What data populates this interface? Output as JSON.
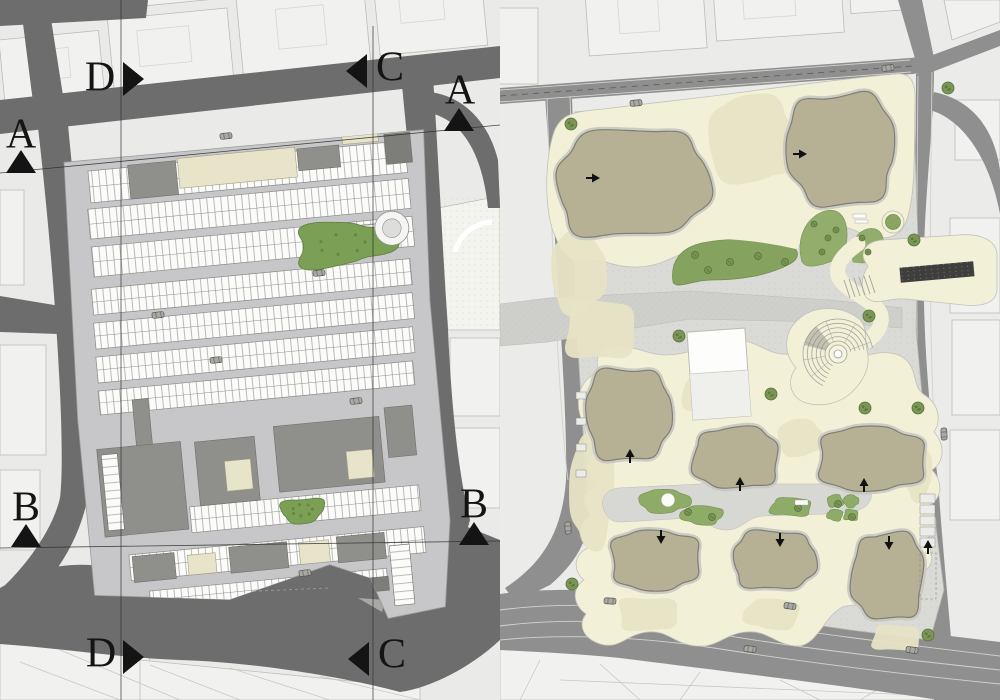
{
  "title": "Architectural site plan pair",
  "colors": {
    "bg": "#eaeae8",
    "city_block": "#f1f1ef",
    "city_line": "#bcbcb7",
    "road_left": "#6d6d6d",
    "road_right": "#8f8f8f",
    "road_edge": "#cfcfca",
    "plaza": "#c7c7c9",
    "stall_bg": "#fbfbf9",
    "stall_line": "#8f8f8b",
    "building_gray": "#8f8f8c",
    "building_dark": "#7d7d79",
    "beige": "#e8e4ca",
    "green": "#7ba055",
    "green_edge": "#5d7f3f",
    "paving": "#dadad6",
    "cream": "#f3f0d8",
    "khaki": "#e7e3c5",
    "olive": "#b6b194",
    "olive_edge": "#7f7f76",
    "olive_ring": "#c8c8c0",
    "lawn": "#85a35f",
    "bed": "#93ad6d",
    "tree": "#7b9554",
    "tree_edge": "#55713a",
    "marker": "#141414",
    "canopy": "#3e3e3c",
    "white_bldg": "#fdfdfc"
  },
  "left_plan": {
    "name": "ground floor plan with section markers",
    "markers": [
      {
        "id": "D-top",
        "label": "D",
        "lx": 100,
        "ly": 81,
        "dir": "right",
        "tip": [
          144,
          79
        ]
      },
      {
        "id": "C-top",
        "label": "C",
        "lx": 390,
        "ly": 71,
        "dir": "left",
        "tip": [
          346,
          71
        ]
      },
      {
        "id": "A-top-right",
        "label": "A",
        "lx": 460,
        "ly": 94,
        "dir": "up",
        "tip": [
          459,
          108
        ]
      },
      {
        "id": "A-left",
        "label": "A",
        "lx": 21,
        "ly": 138,
        "dir": "up",
        "tip": [
          21,
          150
        ]
      },
      {
        "id": "B-left",
        "label": "B",
        "lx": 26,
        "ly": 511,
        "dir": "up",
        "tip": [
          26,
          524
        ]
      },
      {
        "id": "B-right",
        "label": "B",
        "lx": 474,
        "ly": 508,
        "dir": "up",
        "tip": [
          474,
          522
        ]
      },
      {
        "id": "D-bottom",
        "label": "D",
        "lx": 101,
        "ly": 657,
        "dir": "right",
        "tip": [
          144,
          657
        ]
      },
      {
        "id": "C-bottom",
        "label": "C",
        "lx": 392,
        "ly": 658,
        "dir": "left",
        "tip": [
          348,
          659
        ]
      }
    ],
    "section_lines": [
      [
        121,
        0,
        121,
        700
      ],
      [
        373,
        26,
        373,
        700
      ],
      [
        0,
        173,
        500,
        125
      ],
      [
        0,
        548,
        500,
        541
      ]
    ],
    "stall_bands": [
      {
        "x": 88,
        "y": 168,
        "w": 318,
        "h": 32
      },
      {
        "x": 84,
        "y": 206,
        "w": 322,
        "h": 30
      },
      {
        "x": 84,
        "y": 244,
        "w": 322,
        "h": 30
      },
      {
        "x": 80,
        "y": 286,
        "w": 320,
        "h": 26
      },
      {
        "x": 79,
        "y": 320,
        "w": 320,
        "h": 26
      },
      {
        "x": 78,
        "y": 354,
        "w": 318,
        "h": 26
      },
      {
        "x": 77,
        "y": 388,
        "w": 316,
        "h": 24
      },
      {
        "x": 157,
        "y": 512,
        "w": 230,
        "h": 26
      },
      {
        "x": 92,
        "y": 554,
        "w": 296,
        "h": 26
      },
      {
        "x": 109,
        "y": 592,
        "w": 238,
        "h": 18
      }
    ],
    "blocks": [
      {
        "x": 128,
        "y": 166,
        "w": 48,
        "h": 34,
        "f": "g"
      },
      {
        "x": 178,
        "y": 164,
        "w": 118,
        "h": 30,
        "f": "b"
      },
      {
        "x": 298,
        "y": 166,
        "w": 42,
        "h": 22,
        "f": "g"
      },
      {
        "x": 344,
        "y": 146,
        "w": 36,
        "h": 20,
        "f": "b"
      },
      {
        "x": 386,
        "y": 160,
        "w": 26,
        "h": 30,
        "f": "g2"
      },
      {
        "x": 344,
        "y": 248,
        "w": 38,
        "h": 16,
        "f": "w"
      },
      {
        "x": 110,
        "y": 400,
        "w": 16,
        "h": 48,
        "f": "g"
      },
      {
        "x": 70,
        "y": 446,
        "w": 84,
        "h": 88,
        "f": "g"
      },
      {
        "x": 74,
        "y": 452,
        "w": 16,
        "h": 76,
        "f": "w"
      },
      {
        "x": 168,
        "y": 448,
        "w": 60,
        "h": 64,
        "f": "g"
      },
      {
        "x": 196,
        "y": 470,
        "w": 26,
        "h": 30,
        "f": "b"
      },
      {
        "x": 248,
        "y": 440,
        "w": 106,
        "h": 66,
        "f": "g"
      },
      {
        "x": 318,
        "y": 472,
        "w": 26,
        "h": 28,
        "f": "b"
      },
      {
        "x": 360,
        "y": 432,
        "w": 28,
        "h": 50,
        "f": "g"
      },
      {
        "x": 95,
        "y": 556,
        "w": 42,
        "h": 26,
        "f": "g"
      },
      {
        "x": 150,
        "y": 560,
        "w": 28,
        "h": 20,
        "f": "b"
      },
      {
        "x": 192,
        "y": 556,
        "w": 58,
        "h": 26,
        "f": "g"
      },
      {
        "x": 262,
        "y": 558,
        "w": 30,
        "h": 22,
        "f": "b"
      },
      {
        "x": 300,
        "y": 556,
        "w": 48,
        "h": 26,
        "f": "g"
      },
      {
        "x": 352,
        "y": 570,
        "w": 20,
        "h": 60,
        "f": "w"
      },
      {
        "x": 322,
        "y": 600,
        "w": 26,
        "h": 14,
        "f": "g2"
      }
    ],
    "green_areas": [
      {
        "cx": 334,
        "cy": 265,
        "w": 96,
        "h": 42,
        "ph": 1.1
      },
      {
        "cx": 269,
        "cy": 526,
        "w": 42,
        "h": 24,
        "ph": 2.4
      }
    ],
    "circular_ramp": {
      "cx": 385,
      "cy": 254,
      "r": 17
    },
    "cars": [
      [
        226,
        136
      ],
      [
        319,
        273
      ],
      [
        158,
        315
      ],
      [
        216,
        360
      ],
      [
        356,
        401
      ],
      [
        305,
        573
      ]
    ]
  },
  "right_plan": {
    "name": "landscape site plan",
    "buildings": [
      {
        "cx": 632,
        "cy": 183,
        "w": 148,
        "h": 106,
        "rot": -5,
        "ph": 0.5
      },
      {
        "cx": 841,
        "cy": 149,
        "w": 104,
        "h": 112,
        "rot": -4,
        "ph": 2.1
      },
      {
        "cx": 628,
        "cy": 414,
        "w": 82,
        "h": 92,
        "rot": -2,
        "ph": 1.2
      },
      {
        "cx": 736,
        "cy": 458,
        "w": 84,
        "h": 60,
        "rot": 0,
        "ph": 3.3
      },
      {
        "cx": 871,
        "cy": 459,
        "w": 106,
        "h": 62,
        "rot": 0,
        "ph": 4.4
      },
      {
        "cx": 655,
        "cy": 560,
        "w": 88,
        "h": 58,
        "rot": 0,
        "ph": 5.1
      },
      {
        "cx": 774,
        "cy": 560,
        "w": 80,
        "h": 58,
        "rot": 0,
        "ph": 0.8
      },
      {
        "cx": 888,
        "cy": 576,
        "w": 70,
        "h": 86,
        "rot": 2,
        "ph": 2.9
      }
    ],
    "khaki_patches": [
      {
        "cx": 752,
        "cy": 140,
        "w": 86,
        "h": 86,
        "ph": 0.3
      },
      {
        "cx": 578,
        "cy": 272,
        "w": 52,
        "h": 80,
        "ph": 1.0
      },
      {
        "cx": 600,
        "cy": 330,
        "w": 70,
        "h": 60,
        "ph": 4.2
      },
      {
        "cx": 592,
        "cy": 490,
        "w": 42,
        "h": 110,
        "ph": 2.2
      },
      {
        "cx": 712,
        "cy": 392,
        "w": 56,
        "h": 50,
        "ph": 3.1
      },
      {
        "cx": 800,
        "cy": 438,
        "w": 44,
        "h": 36,
        "ph": 0.7
      },
      {
        "cx": 918,
        "cy": 472,
        "w": 26,
        "h": 56,
        "ph": 1.9
      },
      {
        "cx": 648,
        "cy": 614,
        "w": 60,
        "h": 34,
        "ph": 5.0
      },
      {
        "cx": 772,
        "cy": 614,
        "w": 54,
        "h": 30,
        "ph": 2.8
      },
      {
        "cx": 896,
        "cy": 638,
        "w": 48,
        "h": 26,
        "ph": 3.9
      }
    ],
    "green_islands": [
      {
        "cx": 664,
        "cy": 501,
        "w": 48,
        "h": 22,
        "ph": 1.2
      },
      {
        "cx": 702,
        "cy": 515,
        "w": 40,
        "h": 18,
        "ph": 2.3
      },
      {
        "cx": 791,
        "cy": 507,
        "w": 40,
        "h": 18,
        "ph": 3.4
      },
      {
        "cx": 835,
        "cy": 501,
        "w": 15,
        "h": 12,
        "ph": 0.2
      },
      {
        "cx": 851,
        "cy": 501,
        "w": 14,
        "h": 12,
        "ph": 1.5
      },
      {
        "cx": 835,
        "cy": 515,
        "w": 15,
        "h": 11,
        "ph": 2.6
      },
      {
        "cx": 851,
        "cy": 515,
        "w": 14,
        "h": 11,
        "ph": 3.7
      }
    ],
    "trees": [
      [
        571,
        124
      ],
      [
        948,
        88
      ],
      [
        914,
        240
      ],
      [
        679,
        336
      ],
      [
        771,
        394
      ],
      [
        869,
        316
      ],
      [
        865,
        408
      ],
      [
        918,
        408
      ],
      [
        572,
        584
      ],
      [
        928,
        635
      ]
    ],
    "lawn_trees": [
      [
        695,
        255
      ],
      [
        730,
        262
      ],
      [
        758,
        256
      ],
      [
        785,
        262
      ],
      [
        708,
        270
      ]
    ],
    "bed_trees": [
      [
        814,
        224
      ],
      [
        828,
        238
      ],
      [
        822,
        252
      ],
      [
        836,
        230
      ],
      [
        862,
        238
      ],
      [
        868,
        252
      ]
    ],
    "island_trees": [
      [
        688,
        512
      ],
      [
        712,
        517
      ],
      [
        798,
        508
      ],
      [
        838,
        504
      ],
      [
        852,
        517
      ]
    ],
    "arrows": [
      {
        "x": 590,
        "y": 178,
        "d": "r"
      },
      {
        "x": 797,
        "y": 154,
        "d": "r"
      },
      {
        "x": 630,
        "y": 459,
        "d": "u"
      },
      {
        "x": 740,
        "y": 487,
        "d": "u"
      },
      {
        "x": 864,
        "y": 488,
        "d": "u"
      },
      {
        "x": 661,
        "y": 534,
        "d": "d"
      },
      {
        "x": 780,
        "y": 537,
        "d": "d"
      },
      {
        "x": 889,
        "y": 540,
        "d": "d"
      },
      {
        "x": 928,
        "y": 550,
        "d": "u"
      }
    ],
    "cars": [
      [
        636,
        103,
        -5
      ],
      [
        888,
        68,
        -5
      ],
      [
        610,
        601,
        3
      ],
      [
        790,
        606,
        6
      ],
      [
        750,
        649,
        4
      ],
      [
        912,
        650,
        6
      ],
      [
        944,
        434,
        88
      ],
      [
        568,
        528,
        88
      ]
    ],
    "parking_bays": {
      "x": 920,
      "y": 494,
      "w": 15,
      "h": 9,
      "count": 5,
      "gap": 11
    },
    "left_road_bays": {
      "x": 576,
      "y": 392,
      "w": 10,
      "h": 7,
      "count": 4,
      "gap": 26
    },
    "amphitheater": {
      "cx": 838,
      "cy": 354,
      "r_inner": 13,
      "r_outer": 35,
      "rings": 6,
      "a1": 115,
      "a2": 350
    },
    "canopy_bar": {
      "cx": 937,
      "cy": 272,
      "w": 74,
      "h": 15,
      "rot": -5
    },
    "planter": {
      "cx": 893,
      "cy": 222,
      "r": 11
    }
  }
}
